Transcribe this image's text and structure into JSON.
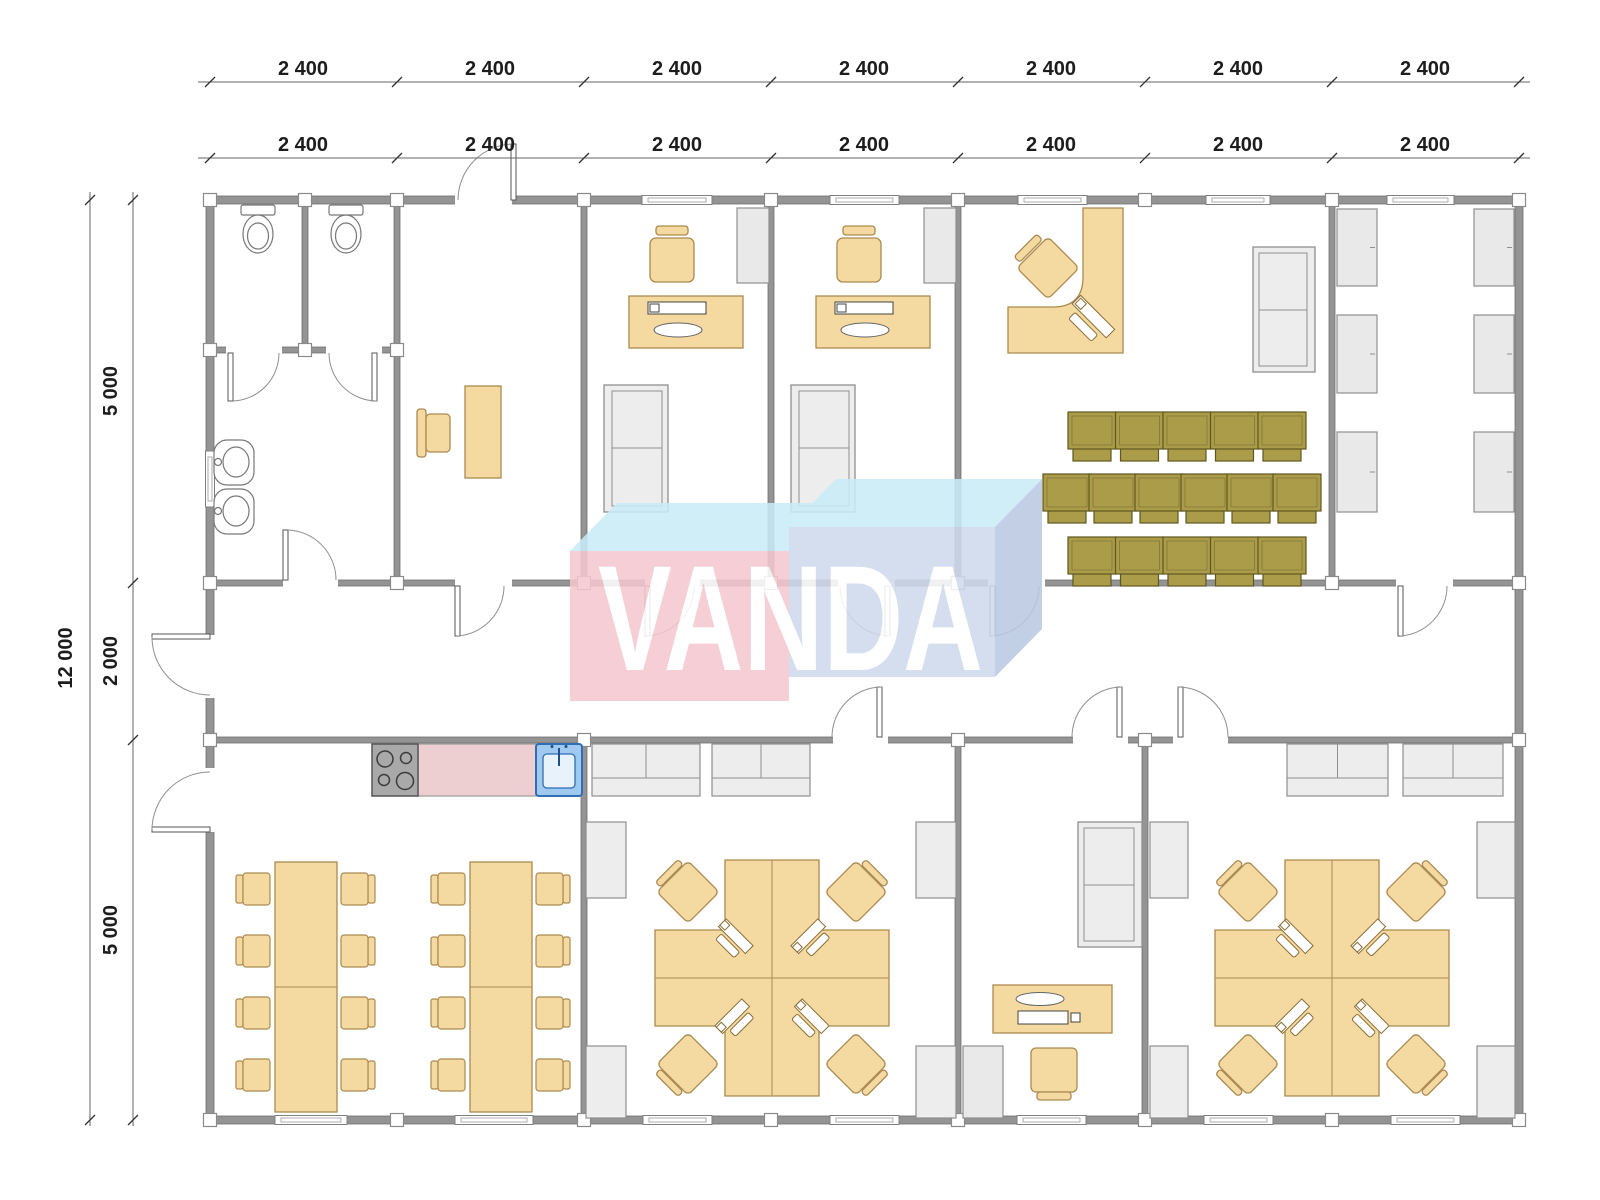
{
  "watermark": {
    "text": "VANDA"
  },
  "dimensions": {
    "top_rows": [
      {
        "y": 75,
        "labels": [
          {
            "text": "2 400",
            "x": 303
          },
          {
            "text": "2 400",
            "x": 490
          },
          {
            "text": "2 400",
            "x": 677
          },
          {
            "text": "2 400",
            "x": 864
          },
          {
            "text": "2 400",
            "x": 1051
          },
          {
            "text": "2 400",
            "x": 1238
          },
          {
            "text": "2 400",
            "x": 1425
          }
        ]
      },
      {
        "y": 151,
        "labels": [
          {
            "text": "2 400",
            "x": 303
          },
          {
            "text": "2 400",
            "x": 490
          },
          {
            "text": "2 400",
            "x": 677
          },
          {
            "text": "2 400",
            "x": 864
          },
          {
            "text": "2 400",
            "x": 1051
          },
          {
            "text": "2 400",
            "x": 1238
          },
          {
            "text": "2 400",
            "x": 1425
          }
        ]
      }
    ],
    "left_total": {
      "text": "12 000",
      "x": 72,
      "y": 658
    },
    "left_segments": [
      {
        "text": "5 000",
        "x": 117,
        "y": 391
      },
      {
        "text": "2 000",
        "x": 117,
        "y": 661
      },
      {
        "text": "5 000",
        "x": 117,
        "y": 930
      }
    ]
  },
  "colors": {
    "wall": "#949494",
    "furniture_tan": "#f4d9a1",
    "furniture_tan_stroke": "#ab8a50",
    "chair_olive": "#ab9c4a",
    "chair_olive_stroke": "#5f571f",
    "gray_furniture": "#ededed",
    "counter_pink": "#edcfd2",
    "sink_blue": "#9fc9ef",
    "sink_blue_stroke": "#2f6db5",
    "watermark_pink": "#f4c8cf",
    "watermark_cyan": "#c9ecf8",
    "watermark_periwinkle": "#cfdaec",
    "watermark_side": "#b9c9e2"
  }
}
